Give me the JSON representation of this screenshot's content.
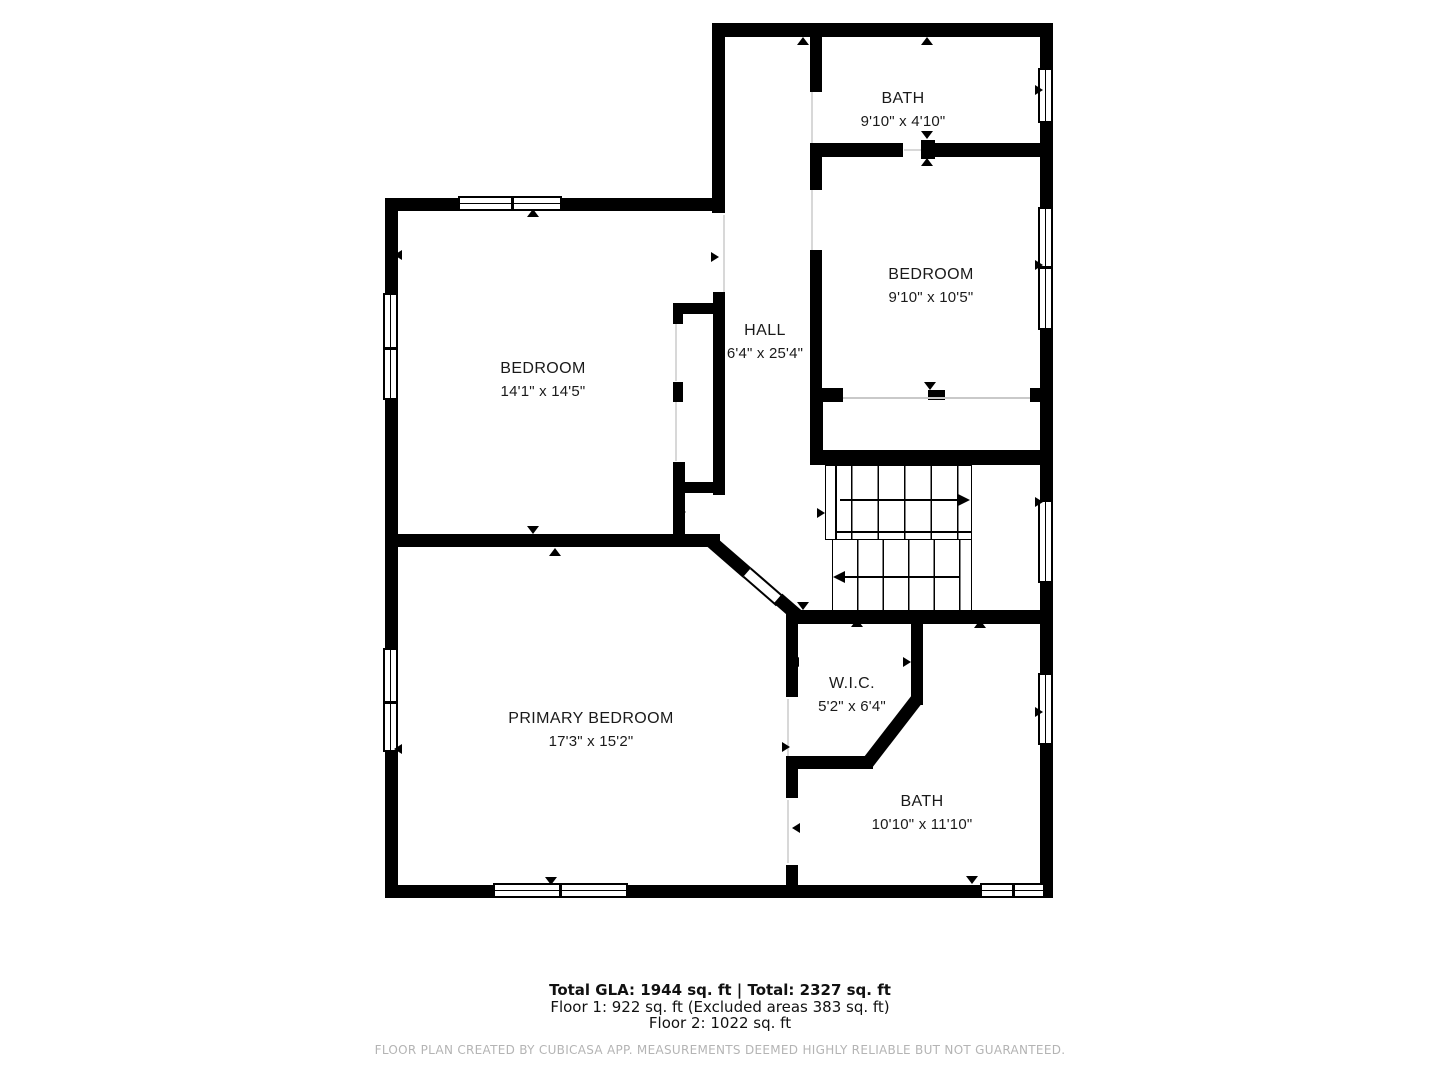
{
  "rooms": {
    "bath_top": {
      "name": "BATH",
      "dims": "9'10\" x 4'10\""
    },
    "bedroom_right": {
      "name": "BEDROOM",
      "dims": "9'10\" x 10'5\""
    },
    "hall": {
      "name": "HALL",
      "dims": "6'4\" x 25'4\""
    },
    "bedroom_left": {
      "name": "BEDROOM",
      "dims": "14'1\" x 14'5\""
    },
    "primary_bedroom": {
      "name": "PRIMARY BEDROOM",
      "dims": "17'3\" x 15'2\""
    },
    "wic": {
      "name": "W.I.C.",
      "dims": "5'2\" x 6'4\""
    },
    "bath_bottom": {
      "name": "BATH",
      "dims": "10'10\" x 11'10\""
    }
  },
  "footer": {
    "total_line": "Total GLA: 1944 sq. ft | Total: 2327 sq. ft",
    "floor1_line": "Floor 1: 922 sq. ft (Excluded areas 383 sq. ft)",
    "floor2_line": "Floor 2: 1022 sq. ft",
    "disclaimer": "FLOOR PLAN CREATED BY CUBICASA APP. MEASUREMENTS DEEMED HIGHLY RELIABLE BUT NOT GUARANTEED."
  },
  "colors": {
    "wall": "#000000",
    "background": "#ffffff",
    "disclaimer_text": "#b4b4b4"
  }
}
